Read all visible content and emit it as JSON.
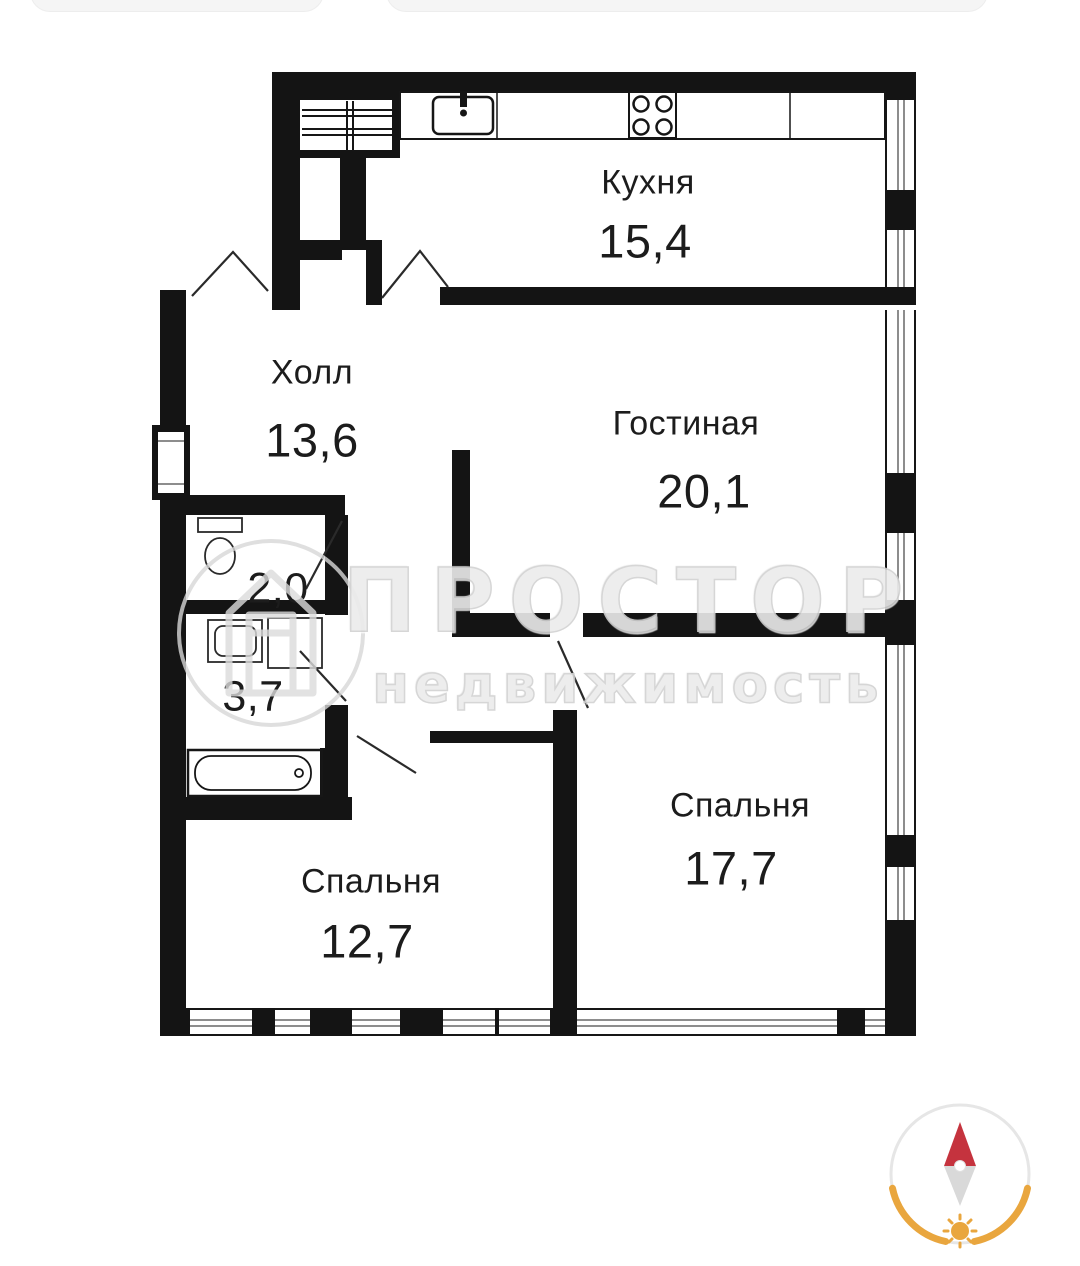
{
  "document": {
    "type": "apartment-floor-plan"
  },
  "rooms": [
    {
      "id": "kitchen",
      "name": "Кухня",
      "area": "15,4"
    },
    {
      "id": "hall",
      "name": "Холл",
      "area": "13,6"
    },
    {
      "id": "living-room",
      "name": "Гостиная",
      "area": "20,1"
    },
    {
      "id": "wc",
      "name": "",
      "area": "2,0"
    },
    {
      "id": "bathroom",
      "name": "",
      "area": "3,7"
    },
    {
      "id": "bedroom-right",
      "name": "Спальня",
      "area": "17,7"
    },
    {
      "id": "bedroom-left",
      "name": "Спальня",
      "area": "12,7"
    }
  ],
  "watermark": {
    "brand": "ПРОСТОР",
    "subtitle": "недвижимость"
  },
  "fixtures": [
    "ventilation-shaft",
    "kitchen-counter",
    "kitchen-sink",
    "stove",
    "toilet",
    "washbasin",
    "washing-machine",
    "bathtub"
  ],
  "colors": {
    "wall": "#141414",
    "background": "#ffffff",
    "watermark_gray": "#ececec",
    "compass_red": "#c5333e",
    "compass_orange": "#e9a63e",
    "compass_gray": "#d9d9d9",
    "compass_ring": "#e6e6e6"
  }
}
